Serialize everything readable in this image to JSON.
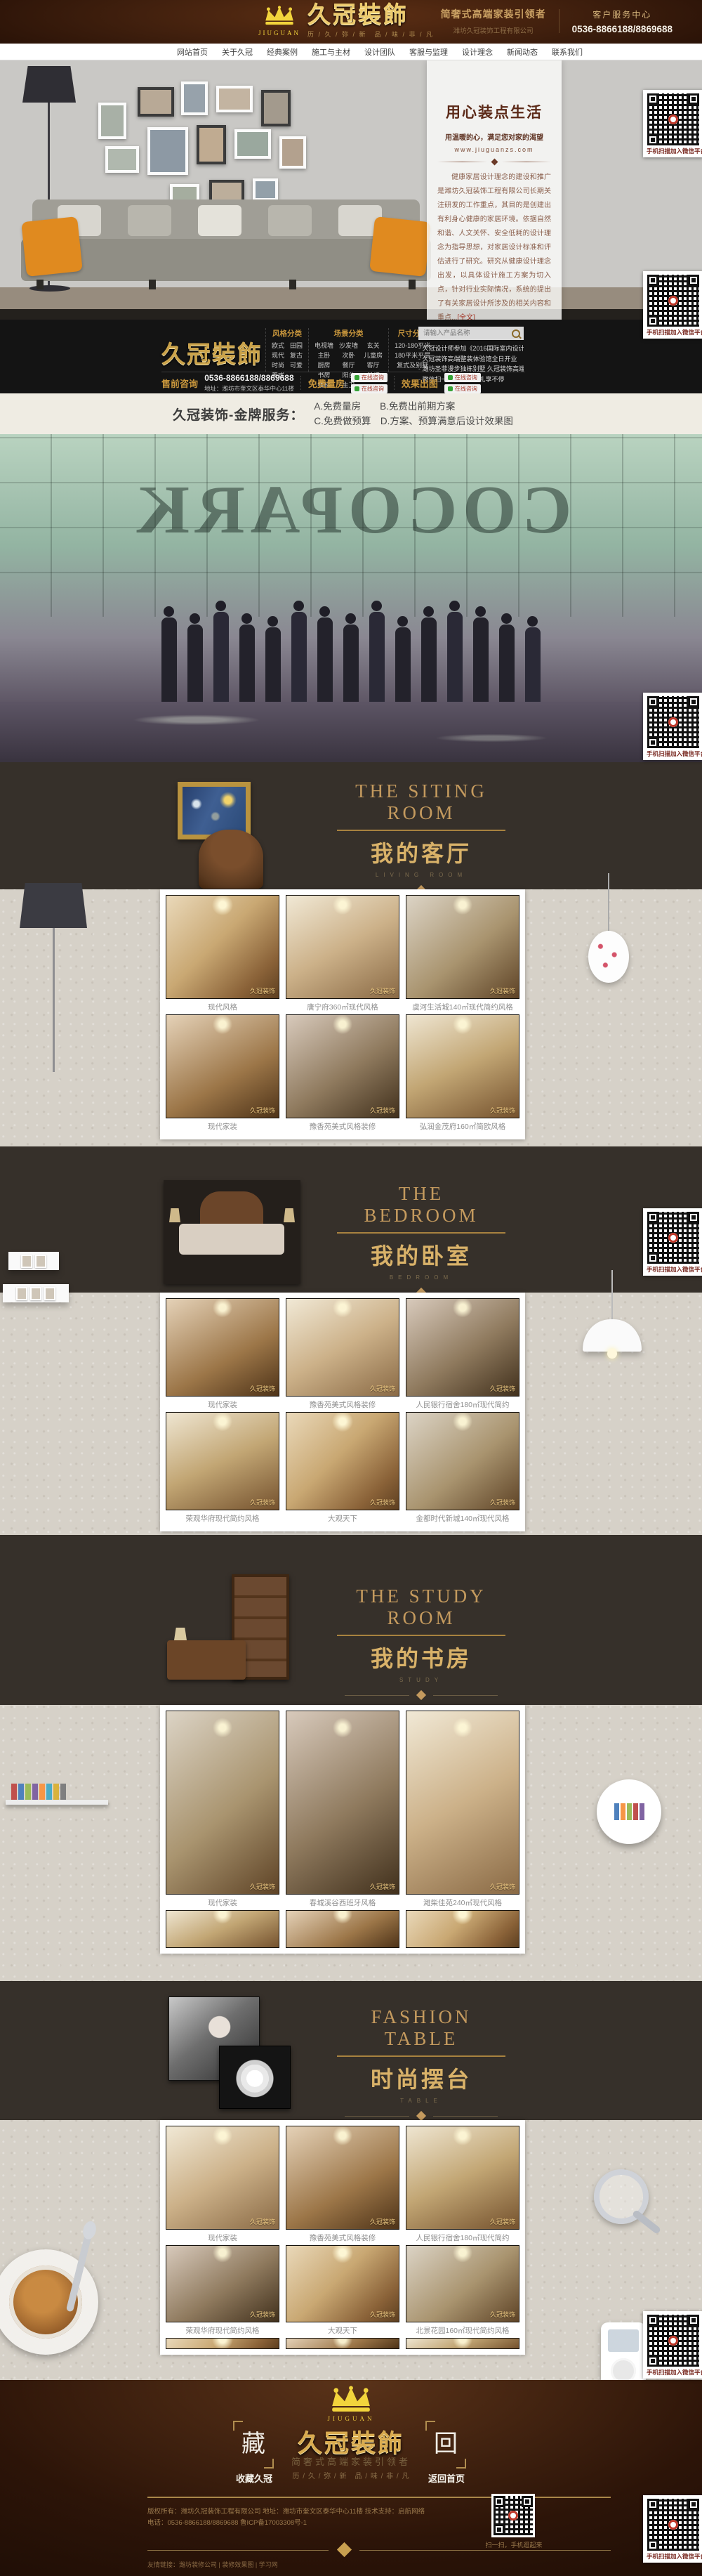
{
  "header": {
    "logo_en": "JIUGUAN",
    "logo_zh": "久冠裝飾",
    "tagline": "历 / 久 / 弥 / 新　品 / 味 / 非 / 凡",
    "slogan": "简奢式高端家装引领者",
    "company": "潍坊久冠装饰工程有限公司",
    "service_center": "客户服务中心",
    "phone": "0536-8866188/8869688"
  },
  "nav": {
    "items": [
      "网站首页",
      "关于久冠",
      "经典案例",
      "施工与主材",
      "设计团队",
      "客服与监理",
      "设计理念",
      "新闻动态",
      "联系我们"
    ]
  },
  "hero": {
    "title": "用心装点生活",
    "subtitle": "用温暖的心，满足您对家的渴望",
    "website": "www.jiuguanzs.com",
    "paragraph": "健康家居设计理念的建设和推广是潍坊久冠装饰工程有限公司长期关注研发的工作重点，其目的是创建出有利身心健康的家居环境。依据自然和谐、人文关怀、安全低耗的设计理念为指导思想，对家居设计标准和评估进行了研究。研究从健康设计理念出发，以具体设计施工方案为切入点，针对行业实际情况，系统的提出了有关家居设计所涉及的相关内容和重点...",
    "more": "[全文]"
  },
  "qr": {
    "caption": "手机扫描加入微信平台"
  },
  "contact": {
    "logo": "久冠裝飾",
    "style_cat": {
      "title": "风格分类",
      "items": [
        "欧式",
        "田园",
        "现代",
        "复古",
        "时尚",
        "可爱",
        "美式"
      ]
    },
    "scene_cat": {
      "title": "场景分类",
      "items": [
        "电视墙",
        "沙发墙",
        "玄关",
        "主卧",
        "次卧",
        "儿童房",
        "厨房",
        "餐厅",
        "客厅",
        "书房",
        "阳台",
        "吊灯",
        "楼梯",
        "主卫"
      ]
    },
    "size_cat": {
      "title": "尺寸分类",
      "items": [
        "120-180平米",
        "180平米平层",
        "复式及别墅"
      ]
    },
    "search_placeholder": "请输入产品名称",
    "news": [
      "久冠设计师参加《2016国际室内设计趋势解析》",
      "久冠装饰高端整装体验馆全日开业",
      "潍坊圣菲漫步独栋别墅 久冠装饰高端设计",
      "微信扫一扫，折扣好礼享不停"
    ],
    "presale": "售前咨询",
    "phone": "0536-8866188/8869688",
    "address": "地址：潍坊市奎文区泰华中心11楼",
    "measure": "免费量房",
    "render": "效果出图",
    "consult": "在线咨询"
  },
  "service_bar": {
    "title": "久冠装饰-金牌服务：",
    "line1": "A.免费量房　　B.免费出前期方案",
    "line2": "C.免费做预算　D.方案、预算满意后设计效果图"
  },
  "team": {
    "sign": "COCOPARK"
  },
  "gallery": {
    "watermark": "久冠装饰"
  },
  "sections": {
    "living": {
      "en1": "THE SITING",
      "en2": "ROOM",
      "zh": "我的客厅",
      "sub": "LIVING ROOM",
      "captions_r1": [
        "现代风格",
        "唐宁府360㎡现代风格",
        "虞河生活城140㎡现代简约风格"
      ],
      "captions_r2": [
        "现代家装",
        "豫香苑美式风格装修",
        "弘润金茂府160㎡简欧风格"
      ]
    },
    "bedroom": {
      "en1": "THE",
      "en2": "BEDROOM",
      "zh": "我的卧室",
      "sub": "BEDROOM",
      "captions_r1": [
        "现代家装",
        "豫香苑美式风格装修",
        "人民银行宿舍180㎡现代简约"
      ],
      "captions_r2": [
        "荣观华府现代简约风格",
        "大观天下",
        "金都时代新城140㎡现代风格"
      ]
    },
    "study": {
      "en1": "THE STUDY",
      "en2": "ROOM",
      "zh": "我的书房",
      "sub": "STUDY",
      "captions_r1": [
        "现代家装",
        "春城溪谷西班牙风格",
        "潍柴佳苑240㎡现代风格"
      ]
    },
    "fashion": {
      "en1": "FASHION",
      "en2": "TABLE",
      "zh": "时尚摆台",
      "sub": "TABLE",
      "captions_r1": [
        "现代家装",
        "豫香苑美式风格装修",
        "人民银行宿舍180㎡现代简约"
      ],
      "captions_r2": [
        "荣观华府现代简约风格",
        "大观天下",
        "北景花园160㎡现代简约风格"
      ]
    }
  },
  "footer": {
    "logo_en": "JIUGUAN",
    "logo_zh": "久冠裝飾",
    "slogan": "简奢式高端家装引领者",
    "tagline": "历 / 久 / 弥 / 新　品 / 味 / 非 / 凡",
    "collect_char": "藏",
    "collect_label": "收藏久冠",
    "back_char": "回",
    "back_label": "返回首页",
    "copyright1": "版权所有：潍坊久冠装饰工程有限公司 地址：潍坊市奎文区泰华中心11楼 技术支持：启航网络",
    "copyright2": "电话：0536-8866188/8869688 鲁ICP备17003308号-1",
    "qr_caption": "扫一扫，手机逛起来",
    "links": "友情链接：潍坊装修公司 | 装修效果图 | 学习网"
  }
}
